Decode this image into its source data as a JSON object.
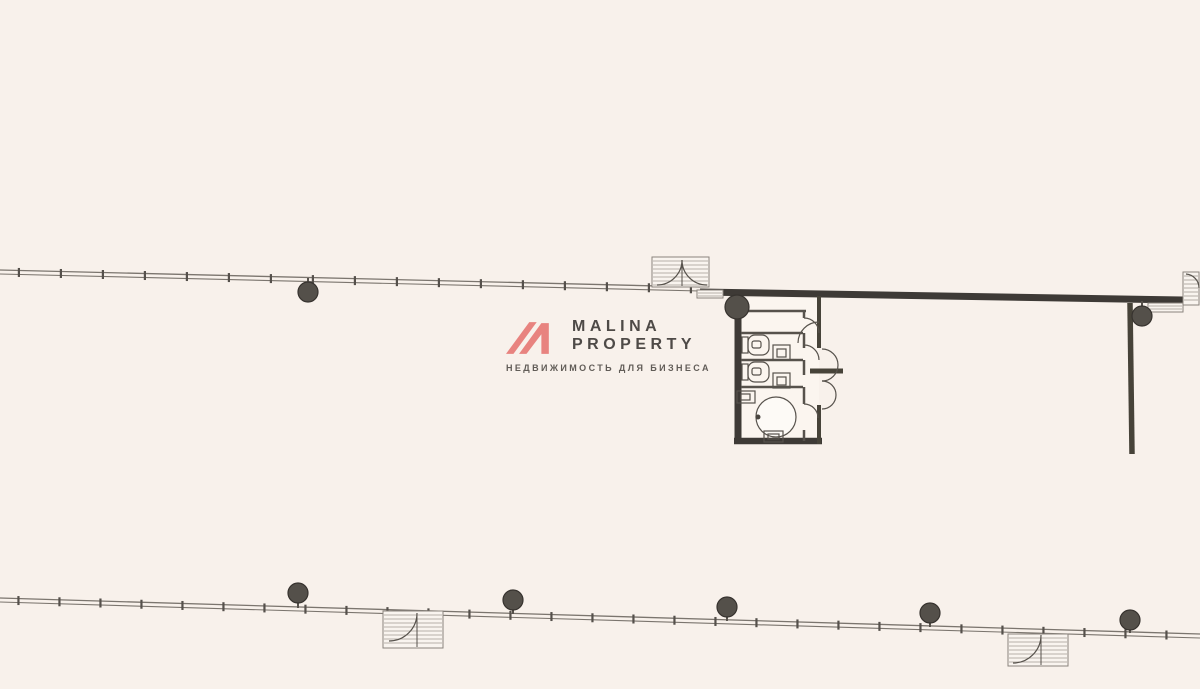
{
  "canvas": {
    "w": 1200,
    "h": 689,
    "bg": "#f8f1eb"
  },
  "logo": {
    "title_line1": "MALINA",
    "title_line2": "PROPERTY",
    "subtitle": "НЕДВИЖИМОСТЬ ДЛЯ БИЗНЕСА",
    "mark_color": "#e8837f",
    "text_color": "#4e4a47",
    "subtitle_color": "#615c57"
  },
  "floorplan": {
    "ink": "#57524c",
    "wall_dark": "#3e3a36",
    "thin": "#7b756e",
    "tick": "#55504b",
    "hatch_line": "#a09a92",
    "hatch_fill": "#f9f4ef",
    "column_fill": "#54504a",
    "column_stroke": "#37332f",
    "shapes": [
      {
        "t": "windowwall",
        "n": "curtain-wall-top",
        "x1": 0,
        "y1": 270,
        "x2": 700,
        "y2": 287,
        "step": 42
      },
      {
        "t": "windowwall",
        "n": "curtain-wall-bottom",
        "x1": 0,
        "y1": 598,
        "x2": 1200,
        "y2": 634,
        "step": 41
      },
      {
        "t": "line",
        "n": "bearing-wall-top",
        "x1": 700,
        "y1": 292,
        "x2": 1183,
        "y2": 300,
        "w": 7,
        "c": "#3e3a36"
      },
      {
        "t": "hatchrect",
        "n": "window-hatch-left",
        "x": 697,
        "y": 290,
        "w": 26,
        "h": 8,
        "step": 3
      },
      {
        "t": "hatchrect",
        "n": "window-hatch-right",
        "x": 1148,
        "y": 303,
        "w": 35,
        "h": 9,
        "step": 3
      },
      {
        "t": "hatchrect",
        "n": "door-box-right-edge",
        "x": 1183,
        "y": 272,
        "w": 16,
        "h": 33,
        "step": 4
      },
      {
        "t": "path",
        "n": "door-arc-right-edge",
        "d": "M1186,274 A14,14 0 0 1 1199,288"
      },
      {
        "t": "hatchrect",
        "n": "entrance-vestibule-top",
        "x": 652,
        "y": 257,
        "w": 57,
        "h": 30,
        "step": 4
      },
      {
        "t": "path",
        "n": "entrance-top-left-leaf-arc",
        "d": "M682,260 A25,25 0 0 1 657,285"
      },
      {
        "t": "path",
        "n": "entrance-top-right-leaf-arc",
        "d": "M682,260 A25,25 0 0 0 707,285"
      },
      {
        "t": "line",
        "n": "entrance-top-leaf",
        "x1": 682,
        "y1": 260,
        "x2": 682,
        "y2": 286,
        "w": 1
      },
      {
        "t": "hatchrect",
        "n": "entrance-vestibule-bottom-left",
        "x": 383,
        "y": 611,
        "w": 60,
        "h": 37,
        "step": 4
      },
      {
        "t": "path",
        "n": "entrance-bl-leaf-arc",
        "d": "M389,641 A28,28 0 0 0 417,613"
      },
      {
        "t": "line",
        "n": "entrance-bl-leaf",
        "x1": 417,
        "y1": 613,
        "x2": 417,
        "y2": 647,
        "w": 1
      },
      {
        "t": "hatchrect",
        "n": "entrance-vestibule-bottom-right",
        "x": 1008,
        "y": 634,
        "w": 60,
        "h": 32,
        "step": 4
      },
      {
        "t": "path",
        "n": "entrance-br-leaf-arc",
        "d": "M1013,663 A28,28 0 0 0 1041,635"
      },
      {
        "t": "line",
        "n": "entrance-br-leaf",
        "x1": 1041,
        "y1": 635,
        "x2": 1041,
        "y2": 665,
        "w": 1
      },
      {
        "t": "line",
        "n": "partition-wall-right",
        "x1": 1130,
        "y1": 303,
        "x2": 1132,
        "y2": 454,
        "w": 5.5,
        "c": "#474339"
      },
      {
        "t": "rect",
        "n": "sanitary-block-floor",
        "x": 741,
        "y": 298,
        "w": 78,
        "h": 144,
        "fill": "#fbf5ef",
        "stroke": "none"
      },
      {
        "t": "line",
        "n": "sanitary-left-wall",
        "x1": 738,
        "y1": 300,
        "x2": 738,
        "y2": 444,
        "w": 7,
        "c": "#3e3a36"
      },
      {
        "t": "line",
        "n": "sanitary-bottom-wall",
        "x1": 734,
        "y1": 441,
        "x2": 822,
        "y2": 441,
        "w": 6.5,
        "c": "#3e3a36"
      },
      {
        "t": "line",
        "n": "sanitary-right-wall-upper",
        "x1": 819,
        "y1": 296,
        "x2": 819,
        "y2": 348,
        "w": 4,
        "c": "#474339"
      },
      {
        "t": "line",
        "n": "sanitary-right-wall-lower",
        "x1": 819,
        "y1": 405,
        "x2": 819,
        "y2": 444,
        "w": 4,
        "c": "#474339"
      },
      {
        "t": "line",
        "n": "sanitary-mid-shelf",
        "x1": 810,
        "y1": 371,
        "x2": 843,
        "y2": 371,
        "w": 5,
        "c": "#474339"
      },
      {
        "t": "line",
        "n": "stall-top-wall",
        "x1": 741,
        "y1": 311,
        "x2": 806,
        "y2": 311,
        "w": 2.5
      },
      {
        "t": "line",
        "n": "stall-divider-1",
        "x1": 741,
        "y1": 333,
        "x2": 803,
        "y2": 333,
        "w": 2.5
      },
      {
        "t": "line",
        "n": "stall-divider-2",
        "x1": 741,
        "y1": 360,
        "x2": 803,
        "y2": 360,
        "w": 2.5
      },
      {
        "t": "line",
        "n": "stall-divider-3",
        "x1": 741,
        "y1": 387,
        "x2": 803,
        "y2": 387,
        "w": 2.5
      },
      {
        "t": "line",
        "n": "stall-front-1",
        "x1": 804,
        "y1": 311,
        "x2": 804,
        "y2": 318,
        "w": 2.5
      },
      {
        "t": "line",
        "n": "stall-front-2",
        "x1": 804,
        "y1": 333,
        "x2": 804,
        "y2": 348,
        "w": 2.5
      },
      {
        "t": "line",
        "n": "stall-front-3",
        "x1": 804,
        "y1": 360,
        "x2": 804,
        "y2": 375,
        "w": 2.5
      },
      {
        "t": "line",
        "n": "stall-front-4",
        "x1": 804,
        "y1": 387,
        "x2": 804,
        "y2": 404,
        "w": 2.5
      },
      {
        "t": "line",
        "n": "stall-front-5",
        "x1": 804,
        "y1": 430,
        "x2": 804,
        "y2": 441,
        "w": 2.5
      },
      {
        "t": "path",
        "n": "stall-door-arc-1",
        "d": "M804,318 A15,15 0 0 1 819,333"
      },
      {
        "t": "path",
        "n": "stall-door-arc-2",
        "d": "M804,345 A15,15 0 0 1 819,360"
      },
      {
        "t": "path",
        "n": "stall-door-arc-3",
        "d": "M804,404 A14,14 0 0 1 818,418"
      },
      {
        "t": "path",
        "n": "corridor-door-arc",
        "d": "M819,322 A21,21 0 0 0 798,343"
      },
      {
        "t": "path",
        "n": "outer-door-arc-upper",
        "d": "M822,349 A16,16 0 0 1 822,381"
      },
      {
        "t": "path",
        "n": "outer-door-arc-lower",
        "d": "M822,381 A14,14 0 0 1 822,409"
      },
      {
        "t": "rect",
        "n": "toilet-1-tank",
        "x": 742,
        "y": 337,
        "w": 6,
        "h": 16
      },
      {
        "t": "rect",
        "n": "toilet-1-bowl",
        "x": 748,
        "y": 335,
        "w": 21,
        "h": 20,
        "rx": 7
      },
      {
        "t": "rect",
        "n": "toilet-1-seat",
        "x": 752,
        "y": 341,
        "w": 9,
        "h": 7,
        "rx": 2
      },
      {
        "t": "rect",
        "n": "toilet-2-tank",
        "x": 742,
        "y": 364,
        "w": 6,
        "h": 16
      },
      {
        "t": "rect",
        "n": "toilet-2-bowl",
        "x": 748,
        "y": 362,
        "w": 21,
        "h": 20,
        "rx": 7
      },
      {
        "t": "rect",
        "n": "toilet-2-seat",
        "x": 752,
        "y": 368,
        "w": 9,
        "h": 7,
        "rx": 2
      },
      {
        "t": "rect",
        "n": "sink-1",
        "x": 773,
        "y": 345,
        "w": 17,
        "h": 15
      },
      {
        "t": "rect",
        "n": "sink-1-basin",
        "x": 777,
        "y": 349,
        "w": 9,
        "h": 8
      },
      {
        "t": "rect",
        "n": "sink-2",
        "x": 773,
        "y": 373,
        "w": 17,
        "h": 15
      },
      {
        "t": "rect",
        "n": "sink-2-basin",
        "x": 777,
        "y": 377,
        "w": 9,
        "h": 8
      },
      {
        "t": "rect",
        "n": "washroom-sink",
        "x": 737,
        "y": 391,
        "w": 18,
        "h": 12
      },
      {
        "t": "rect",
        "n": "washroom-sink-basin",
        "x": 741,
        "y": 394,
        "w": 9,
        "h": 6
      },
      {
        "t": "circle",
        "n": "round-fixture",
        "cx": 776,
        "cy": 417,
        "r": 20,
        "fill": "#fdfaf6"
      },
      {
        "t": "circle",
        "n": "round-fixture-drain",
        "cx": 758,
        "cy": 417,
        "r": 2.5,
        "fill": "#4a453f",
        "stroke": "none"
      },
      {
        "t": "rect",
        "n": "pedestal",
        "x": 764,
        "y": 431,
        "w": 19,
        "h": 11
      },
      {
        "t": "rect",
        "n": "pedestal-inner",
        "x": 768,
        "y": 434,
        "w": 11,
        "h": 5
      },
      {
        "t": "line",
        "n": "column-stem-t1",
        "x1": 308,
        "y1": 278,
        "x2": 308,
        "y2": 285,
        "w": 2
      },
      {
        "t": "column",
        "n": "column-top-1",
        "cx": 308,
        "cy": 292,
        "r": 10
      },
      {
        "t": "column",
        "n": "column-top-2",
        "cx": 737,
        "cy": 307,
        "r": 12
      },
      {
        "t": "line",
        "n": "column-stem-t3",
        "x1": 1142,
        "y1": 301,
        "x2": 1142,
        "y2": 308,
        "w": 2
      },
      {
        "t": "column",
        "n": "column-top-3",
        "cx": 1142,
        "cy": 316,
        "r": 10
      },
      {
        "t": "line",
        "n": "column-stem-b1",
        "x1": 298,
        "y1": 600,
        "x2": 298,
        "y2": 608,
        "w": 2
      },
      {
        "t": "column",
        "n": "column-bottom-1",
        "cx": 298,
        "cy": 593,
        "r": 10
      },
      {
        "t": "line",
        "n": "column-stem-b2",
        "x1": 513,
        "y1": 607,
        "x2": 513,
        "y2": 614,
        "w": 2
      },
      {
        "t": "column",
        "n": "column-bottom-2",
        "cx": 513,
        "cy": 600,
        "r": 10
      },
      {
        "t": "line",
        "n": "column-stem-b3",
        "x1": 727,
        "y1": 614,
        "x2": 727,
        "y2": 621,
        "w": 2
      },
      {
        "t": "column",
        "n": "column-bottom-3",
        "cx": 727,
        "cy": 607,
        "r": 10
      },
      {
        "t": "line",
        "n": "column-stem-b4",
        "x1": 930,
        "y1": 620,
        "x2": 930,
        "y2": 627,
        "w": 2
      },
      {
        "t": "column",
        "n": "column-bottom-4",
        "cx": 930,
        "cy": 613,
        "r": 10
      },
      {
        "t": "line",
        "n": "column-stem-b5",
        "x1": 1130,
        "y1": 627,
        "x2": 1130,
        "y2": 633,
        "w": 2
      },
      {
        "t": "column",
        "n": "column-bottom-5",
        "cx": 1130,
        "cy": 620,
        "r": 10
      }
    ]
  }
}
